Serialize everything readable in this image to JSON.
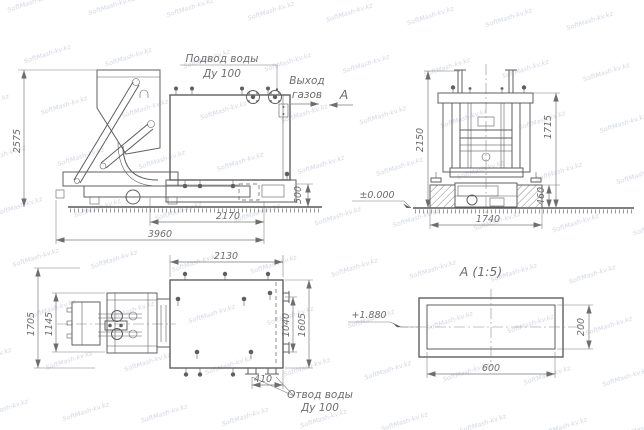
{
  "colors": {
    "background": "#ffffff",
    "ink": "#5f5f5f",
    "dim_text": "#6d6d6d",
    "watermark": "#d0d6e0"
  },
  "watermark": {
    "text": "SoftMash-kv.kz"
  },
  "front_view": {
    "water_inlet": {
      "line1": "Подвод воды",
      "line2": "Ду 100"
    },
    "gas_outlet": {
      "line1": "Выход",
      "line2": "газов"
    },
    "view_letter": "А",
    "dims": {
      "total_height": "2575",
      "tank_length": "2170",
      "total_length": "3960",
      "base_height": "500"
    }
  },
  "side_view": {
    "dims": {
      "frame_height": "2150",
      "tank_height": "1715",
      "foundation_depth": "460",
      "width": "1740"
    },
    "level_mark": "±0.000"
  },
  "plan_view": {
    "water_outlet": {
      "line1": "Отвод воды",
      "line2": "Ду 100"
    },
    "dims": {
      "tank_length": "2130",
      "total_width": "1705",
      "feeder_width": "1145",
      "inner_width": "1040",
      "tank_width": "1605",
      "outlet_spacing": "410"
    }
  },
  "detail_a": {
    "title": "А  (1:5)",
    "level_mark": "+1.880",
    "dims": {
      "width": "600",
      "height": "200"
    }
  }
}
